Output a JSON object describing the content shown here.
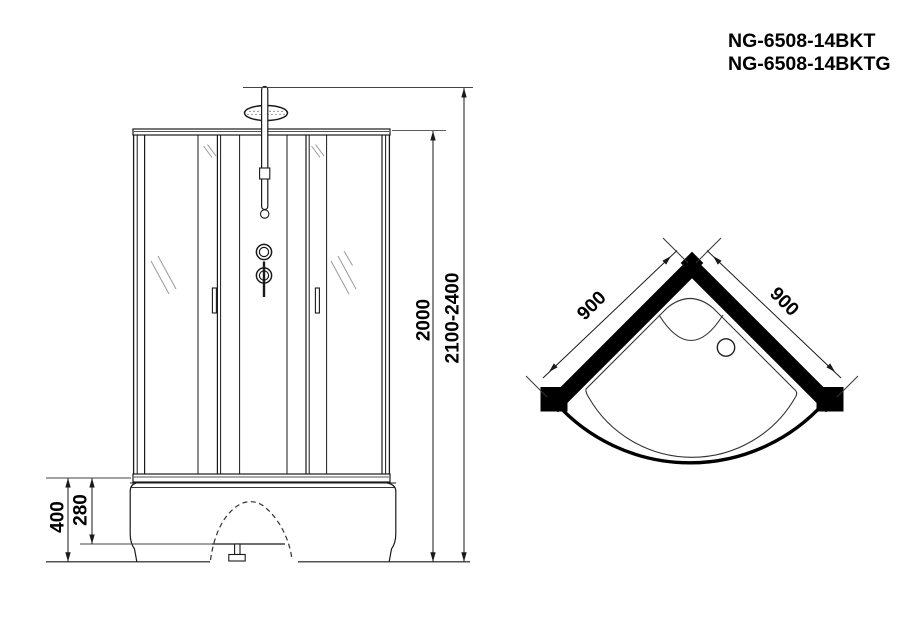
{
  "header": {
    "model_line1": "NG-6508-14BKT",
    "model_line2": "NG-6508-14BKTG"
  },
  "front_view": {
    "dim_glass_height": "2000",
    "dim_total_height": "2100-2400",
    "dim_base_height": "400",
    "dim_base_step": "280"
  },
  "top_view": {
    "dim_side_left": "900",
    "dim_side_right": "900"
  },
  "colors": {
    "ink": "#1a1a1a",
    "wall_black": "#000000",
    "extension_gray": "#444444",
    "glass_mark_gray": "#9a9a9a",
    "background": "#ffffff"
  }
}
